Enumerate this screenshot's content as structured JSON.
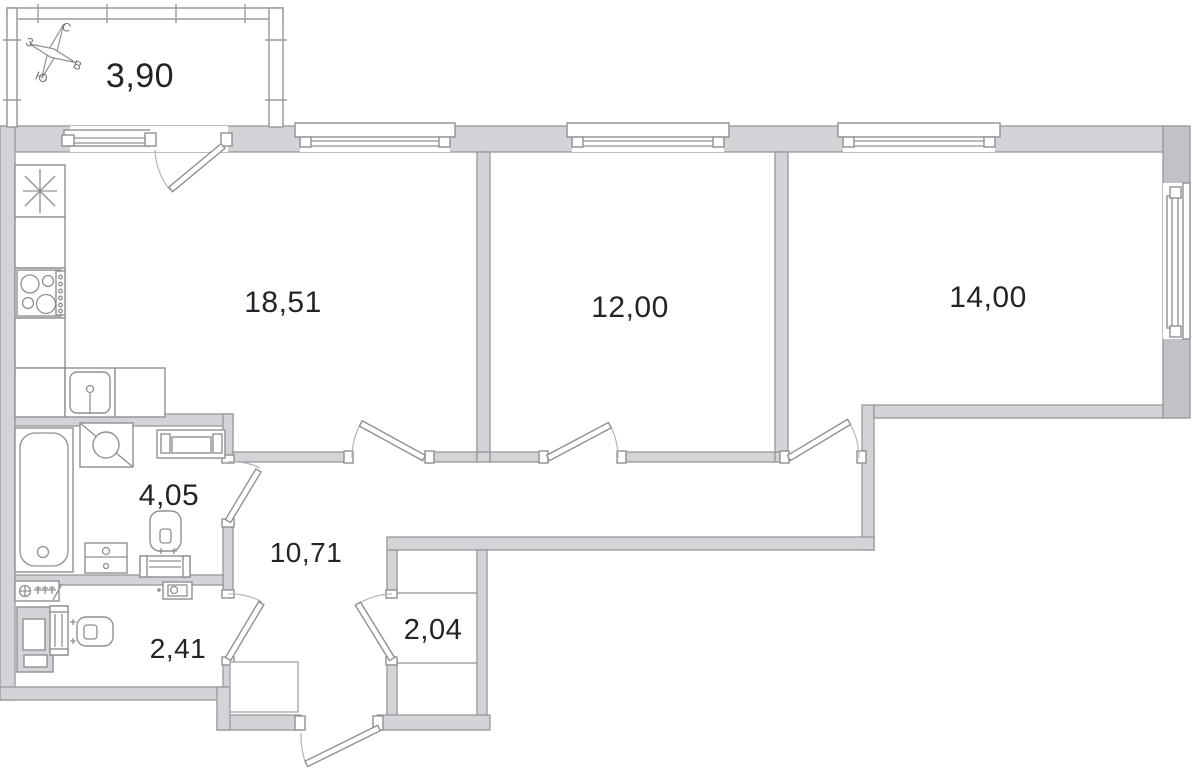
{
  "plan": {
    "compass": {
      "north": "С",
      "west": "З",
      "south": "Ю",
      "east": "В"
    },
    "rooms": [
      {
        "id": "balcony",
        "area_label": "3,90"
      },
      {
        "id": "kitchen-living-room",
        "area_label": "18,51"
      },
      {
        "id": "bedroom-1",
        "area_label": "12,00"
      },
      {
        "id": "bedroom-2",
        "area_label": "14,00"
      },
      {
        "id": "bathroom",
        "area_label": "4,05"
      },
      {
        "id": "hallway",
        "area_label": "10,71"
      },
      {
        "id": "wc",
        "area_label": "2,41"
      },
      {
        "id": "wardrobe",
        "area_label": "2,04"
      }
    ],
    "fixtures": [
      "refrigerator-star-icon",
      "stove-icon",
      "kitchen-sink-icon",
      "bathtub-icon",
      "washing-machine-icon",
      "shelf-unit-icon",
      "toilet-icon",
      "drawer-cabinet-icon",
      "water-meter-icon",
      "vent-shaft-icon",
      "wall-toilet-icon",
      "extractor-box-icon",
      "wardrobe-rail-icon",
      "compass-rose-icon"
    ],
    "colors": {
      "wall_light": "#d3d4d7",
      "wall_dark": "#c1c2c5",
      "line": "#8f9094",
      "arc": "#b3b4b7",
      "text": "#232428"
    }
  }
}
